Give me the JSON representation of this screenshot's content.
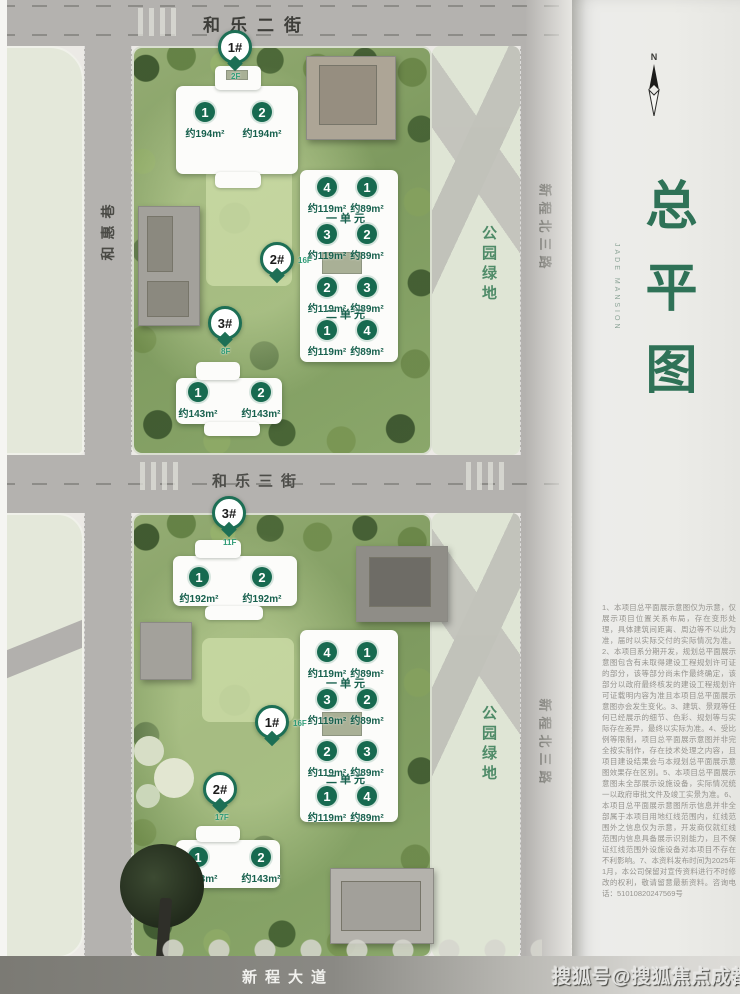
{
  "colors": {
    "accent_green": "#176a50",
    "title_green": "#2f7257",
    "park_green": "#4f8b68",
    "road_gray": "#b4b2af"
  },
  "streets": {
    "top": "和乐二街",
    "left": "和惠巷",
    "middle": "和乐三街",
    "bottom": "新程大道",
    "right": "新程北三路"
  },
  "park_label": "公园绿地",
  "watermark": "搜狐号@搜狐焦点成都站",
  "panel": {
    "compass": "N",
    "title": "总平图",
    "subtitle": "JADE MANSION",
    "disclaimer": "1、本项目总平面展示意图仅为示意，仅展示项目位置关系布局，存在变形处理，具体建筑间距离、周边等不以此为准，届时以实际交付的实际情况为准。2、本项目系分期开发，规划总平面展示意图包含有未取得建设工程规划许可证的部分，该等部分尚未作最终确定，该部分以政府最终核发的建设工程规划许可证载明内容为准且本项目总平面展示意图亦会发生变化。3、建筑、景观等任何已经展示的细节、色彩、规划等与实际存在差异，最终以实际为准。4、受比例等限制，项目总平面展示意图并非完全按实制作，存在技术处理之内容，且项目建设结果会与本规划总平面展示意图效果存在区别。5、本项目总平面展示意图未全部展示设施设备，实际情况统一以政府审批文件及竣工实景为准。6、本项目总平面展示意图所示信息并非全部属于本项目用地红线范围内，红线范围外之信息仅为示意，开发商仅就红线范围内信息具备展示识别能力，且不保证红线范围外设施设备对本项目不存在不利影响。7、本资料发布时间为2025年1月，本公司保留对宣传资料进行不时修改的权利，敬请留意最新资料。咨询电话：51010820247569号"
  },
  "plan_top": {
    "markers": {
      "m1": {
        "id": "1#",
        "floor": "2F"
      },
      "m2": {
        "id": "2#",
        "floor": "16F"
      },
      "m3": {
        "id": "3#",
        "floor": "8F"
      }
    },
    "north_units": [
      {
        "num": "1",
        "area": "约194m²"
      },
      {
        "num": "2",
        "area": "约194m²"
      }
    ],
    "south_units": [
      {
        "num": "1",
        "area": "约143m²"
      },
      {
        "num": "2",
        "area": "约143m²"
      }
    ],
    "slab": {
      "unit1": "一单元",
      "unit2": "二单元",
      "rows": [
        [
          {
            "num": "4",
            "area": "约119m²"
          },
          {
            "num": "1",
            "area": "约89m²"
          }
        ],
        [
          {
            "num": "3",
            "area": "约119m²"
          },
          {
            "num": "2",
            "area": "约89m²"
          }
        ],
        [
          {
            "num": "2",
            "area": "约119m²"
          },
          {
            "num": "3",
            "area": "约89m²"
          }
        ],
        [
          {
            "num": "1",
            "area": "约119m²"
          },
          {
            "num": "4",
            "area": "约89m²"
          }
        ]
      ]
    }
  },
  "plan_bottom": {
    "markers": {
      "m3": {
        "id": "3#",
        "floor": "11F"
      },
      "m1": {
        "id": "1#",
        "floor": "16F"
      },
      "m2": {
        "id": "2#",
        "floor": "17F"
      }
    },
    "north_units": [
      {
        "num": "1",
        "area": "约192m²"
      },
      {
        "num": "2",
        "area": "约192m²"
      }
    ],
    "south_units": [
      {
        "num": "1",
        "area": "约143m²"
      },
      {
        "num": "2",
        "area": "约143m²"
      }
    ],
    "slab": {
      "unit1": "一单元",
      "unit2": "二单元",
      "rows": [
        [
          {
            "num": "4",
            "area": "约119m²"
          },
          {
            "num": "1",
            "area": "约89m²"
          }
        ],
        [
          {
            "num": "3",
            "area": "约119m²"
          },
          {
            "num": "2",
            "area": "约89m²"
          }
        ],
        [
          {
            "num": "2",
            "area": "约119m²"
          },
          {
            "num": "3",
            "area": "约89m²"
          }
        ],
        [
          {
            "num": "1",
            "area": "约119m²"
          },
          {
            "num": "4",
            "area": "约89m²"
          }
        ]
      ]
    }
  }
}
